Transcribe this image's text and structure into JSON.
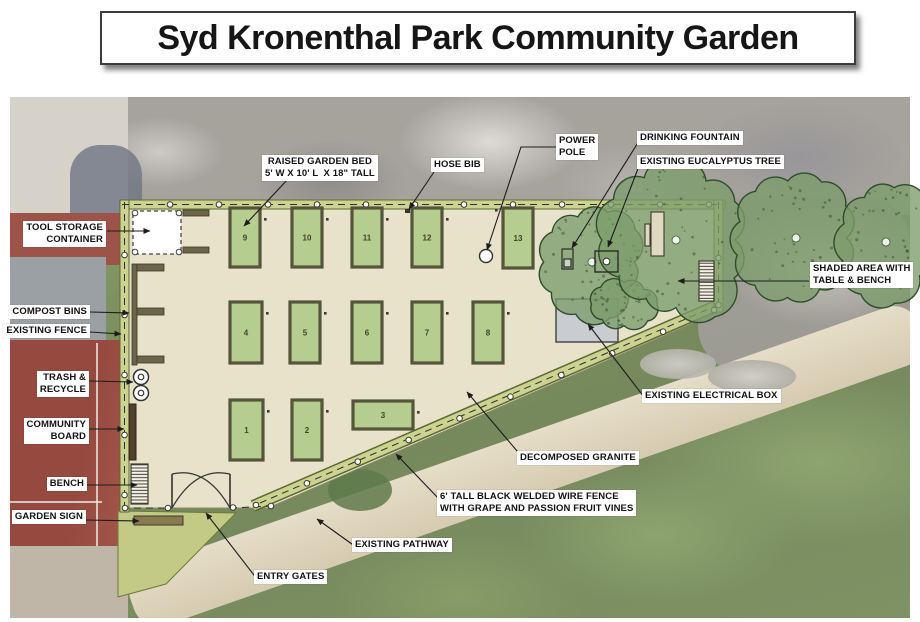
{
  "title": "Syd Kronenthal Park Community Garden",
  "beds": [
    "1",
    "2",
    "3",
    "4",
    "5",
    "6",
    "7",
    "8",
    "9",
    "10",
    "11",
    "12",
    "13"
  ],
  "labels": {
    "tool_storage": "TOOL STORAGE\nCONTAINER",
    "compost_bins": "COMPOST BINS",
    "existing_fence": "EXISTING FENCE",
    "trash_recycle": "TRASH &\nRECYCLE",
    "community_board": "COMMUNITY\nBOARD",
    "bench": "BENCH",
    "garden_sign": "GARDEN SIGN",
    "raised_garden_bed": "RAISED GARDEN BED\n5' W X 10' L  X 18\" TALL",
    "hose_bib": "HOSE BIB",
    "power_pole": "POWER\nPOLE",
    "drinking_fountain": "DRINKING FOUNTAIN",
    "existing_eucalyptus_tree": "EXISTING EUCALYPTUS TREE",
    "shaded_area": "SHADED AREA WITH\nTABLE & BENCH",
    "existing_electrical_box": "EXISTING ELECTRICAL BOX",
    "decomposed_granite": "DECOMPOSED GRANITE",
    "wire_fence": "6' TALL BLACK WELDED WIRE FENCE\nWITH GRAPE AND PASSION FRUIT VINES",
    "existing_pathway": "EXISTING PATHWAY",
    "entry_gates": "ENTRY GATES"
  },
  "colors": {
    "garden_ground": "#e8e2cb",
    "bed_fill": "#b6cd90",
    "bed_border": "#54553a",
    "fence_band": "#ccd28f",
    "tree_green": "#7c9c6b",
    "grass": "#7a9160",
    "pathway": "#ddd3bb",
    "court_red": "#96493f",
    "rocks_gray": "#a6a29c",
    "electrical_box_gray": "#c9ccd1",
    "label_bg": "#ffffff",
    "label_text": "#111111"
  }
}
